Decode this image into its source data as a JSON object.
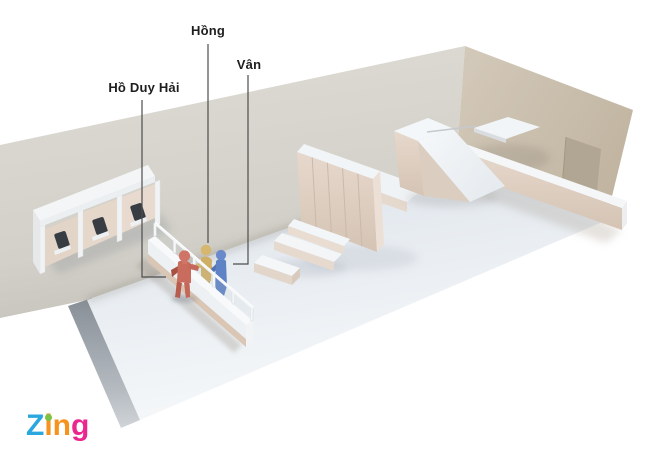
{
  "annotations": {
    "labels": [
      {
        "text": "Hồ Duy Hải"
      },
      {
        "text": "Hồng"
      },
      {
        "text": "Vân"
      }
    ]
  },
  "scene": {
    "figures": [
      {
        "name": "Hồ Duy Hải",
        "color": "#c4685a"
      },
      {
        "name": "Hồng",
        "color": "#cfae66"
      },
      {
        "name": "Vân",
        "color": "#5f82c4"
      }
    ],
    "objects": [
      "phone-booths",
      "service-counter",
      "wardrobe",
      "bed-platform",
      "sofa",
      "coffee-table",
      "staircase-ramp",
      "upper-landing",
      "side-counter",
      "door"
    ],
    "colors": {
      "left_wall": "#d8d6cf",
      "right_wall": "#cbbfae",
      "floor": "#eef2f6",
      "furniture_front": "#e2d4c9",
      "furniture_top": "#f3f6f8",
      "door": "#b1a693",
      "phone": "#3a3f45",
      "leader_line": "#4d4d4d",
      "label_text": "#1e1e1e"
    }
  },
  "logo": {
    "text": "Zing",
    "letters": [
      {
        "char": "Z",
        "color": "#2ba7e0"
      },
      {
        "char": "i",
        "color": "#f6921e",
        "dot_color": "#7dc242"
      },
      {
        "char": "n",
        "color": "#f6921e"
      },
      {
        "char": "g",
        "color": "#ec268f"
      }
    ]
  }
}
